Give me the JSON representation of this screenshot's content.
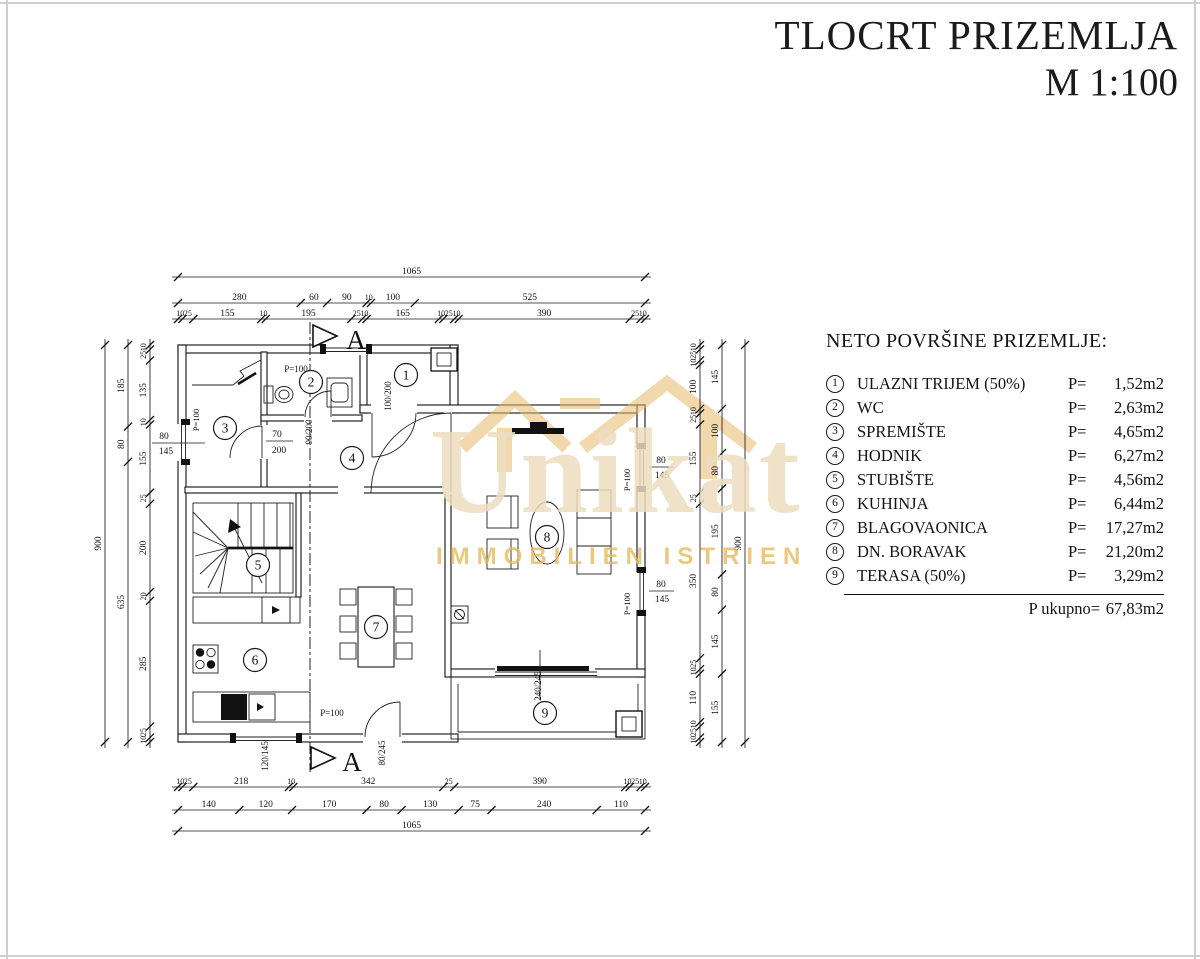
{
  "title": {
    "line1": "TLOCRT PRIZEMLJA",
    "line2": "M 1:100"
  },
  "legend": {
    "heading": "NETO POVRŠINE PRIZEMLJE:",
    "p_label": "P=",
    "items": [
      {
        "num": "1",
        "name": "ULAZNI TRIJEM (50%)",
        "value": "1,52m2"
      },
      {
        "num": "2",
        "name": "WC",
        "value": "2,63m2"
      },
      {
        "num": "3",
        "name": "SPREMIŠTE",
        "value": "4,65m2"
      },
      {
        "num": "4",
        "name": "HODNIK",
        "value": "6,27m2"
      },
      {
        "num": "5",
        "name": "STUBIŠTE",
        "value": "4,56m2"
      },
      {
        "num": "6",
        "name": "KUHINJA",
        "value": "6,44m2"
      },
      {
        "num": "7",
        "name": "BLAGOVAONICA",
        "value": "17,27m2"
      },
      {
        "num": "8",
        "name": "DN. BORAVAK",
        "value": "21,20m2"
      },
      {
        "num": "9",
        "name": "TERASA (50%)",
        "value": "3,29m2"
      }
    ],
    "total_label": "P ukupno=",
    "total_value": "67,83m2"
  },
  "watermark": {
    "brand": "Unikat",
    "subtitle": "IMMOBILIEN ISTRIEN"
  },
  "colors": {
    "gold": "#E6B96B",
    "gold_faint": "#ECDDC0"
  },
  "plan": {
    "rooms": [
      {
        "n": "1",
        "x": 406,
        "y": 375
      },
      {
        "n": "2",
        "x": 311,
        "y": 382
      },
      {
        "n": "3",
        "x": 225,
        "y": 428
      },
      {
        "n": "4",
        "x": 352,
        "y": 458
      },
      {
        "n": "5",
        "x": 258,
        "y": 565
      },
      {
        "n": "6",
        "x": 255,
        "y": 660
      },
      {
        "n": "7",
        "x": 376,
        "y": 627
      },
      {
        "n": "8",
        "x": 547,
        "y": 537
      },
      {
        "n": "9",
        "x": 545,
        "y": 713
      }
    ],
    "chains": [
      {
        "o": "h",
        "pos": 277,
        "from": 178,
        "seg": [
          1065
        ]
      },
      {
        "o": "h",
        "pos": 303,
        "from": 178,
        "seg": [
          280,
          60,
          90,
          10,
          100,
          525
        ]
      },
      {
        "o": "h",
        "pos": 319,
        "from": 178,
        "seg": [
          10,
          25,
          155,
          10,
          195,
          25,
          10,
          165,
          10,
          25,
          10,
          390,
          25,
          10
        ]
      },
      {
        "o": "h",
        "pos": 787,
        "from": 178,
        "seg": [
          10,
          25,
          218,
          10,
          342,
          25,
          390,
          10,
          25,
          10
        ]
      },
      {
        "o": "h",
        "pos": 810,
        "from": 178,
        "seg": [
          140,
          120,
          170,
          80,
          130,
          75,
          240,
          110
        ]
      },
      {
        "o": "h",
        "pos": 831,
        "from": 178,
        "seg": [
          1065
        ]
      },
      {
        "o": "v",
        "pos": 105,
        "from": 345,
        "seg": [
          900
        ]
      },
      {
        "o": "v",
        "pos": 128,
        "from": 345,
        "seg": [
          185,
          80,
          635
        ]
      },
      {
        "o": "v",
        "pos": 150,
        "from": 345,
        "seg": [
          10,
          25,
          135,
          10,
          155,
          25,
          200,
          20,
          285,
          25,
          10
        ]
      },
      {
        "o": "v",
        "pos": 700,
        "from": 345,
        "seg": [
          10,
          25,
          10,
          100,
          10,
          25,
          155,
          25,
          350,
          25,
          10,
          110,
          10,
          25,
          10
        ]
      },
      {
        "o": "v",
        "pos": 722,
        "from": 345,
        "seg": [
          145,
          100,
          80,
          195,
          80,
          145,
          155
        ]
      },
      {
        "o": "v",
        "pos": 745,
        "from": 345,
        "seg": [
          900
        ]
      }
    ],
    "labels": [
      {
        "t": "P=100",
        "x": 296,
        "y": 372,
        "s": 9
      },
      {
        "t": "70",
        "x": 277,
        "y": 437,
        "s": 9.5
      },
      {
        "t": "200",
        "x": 279,
        "y": 453,
        "s": 9.5
      },
      {
        "t": "90/200",
        "x": 312,
        "y": 432,
        "r": -90,
        "s": 9
      },
      {
        "t": "100/200",
        "x": 391,
        "y": 396,
        "r": -90,
        "s": 9
      },
      {
        "t": "P=100",
        "x": 199,
        "y": 420,
        "r": -90,
        "s": 8.5
      },
      {
        "t": "80",
        "x": 164,
        "y": 439,
        "s": 9.5
      },
      {
        "t": "145",
        "x": 166,
        "y": 454,
        "s": 9.5
      },
      {
        "t": "120/145",
        "x": 268,
        "y": 756,
        "r": -90,
        "s": 9
      },
      {
        "t": "P=100",
        "x": 332,
        "y": 716,
        "s": 9
      },
      {
        "t": "80/245",
        "x": 385,
        "y": 753,
        "r": -90,
        "s": 9
      },
      {
        "t": "240/245",
        "x": 541,
        "y": 686,
        "r": -90,
        "s": 9
      },
      {
        "t": "80",
        "x": 661,
        "y": 463,
        "s": 9.5
      },
      {
        "t": "145",
        "x": 662,
        "y": 478,
        "s": 9.5
      },
      {
        "t": "P=100",
        "x": 630,
        "y": 480,
        "r": -90,
        "s": 8.5
      },
      {
        "t": "80",
        "x": 661,
        "y": 587,
        "s": 9.5
      },
      {
        "t": "145",
        "x": 662,
        "y": 602,
        "s": 9.5
      },
      {
        "t": "P=100",
        "x": 630,
        "y": 604,
        "r": -90,
        "s": 8.5
      },
      {
        "t": "A",
        "x": 356,
        "y": 349,
        "s": 27
      },
      {
        "t": "A",
        "x": 352,
        "y": 771,
        "s": 27
      }
    ]
  }
}
